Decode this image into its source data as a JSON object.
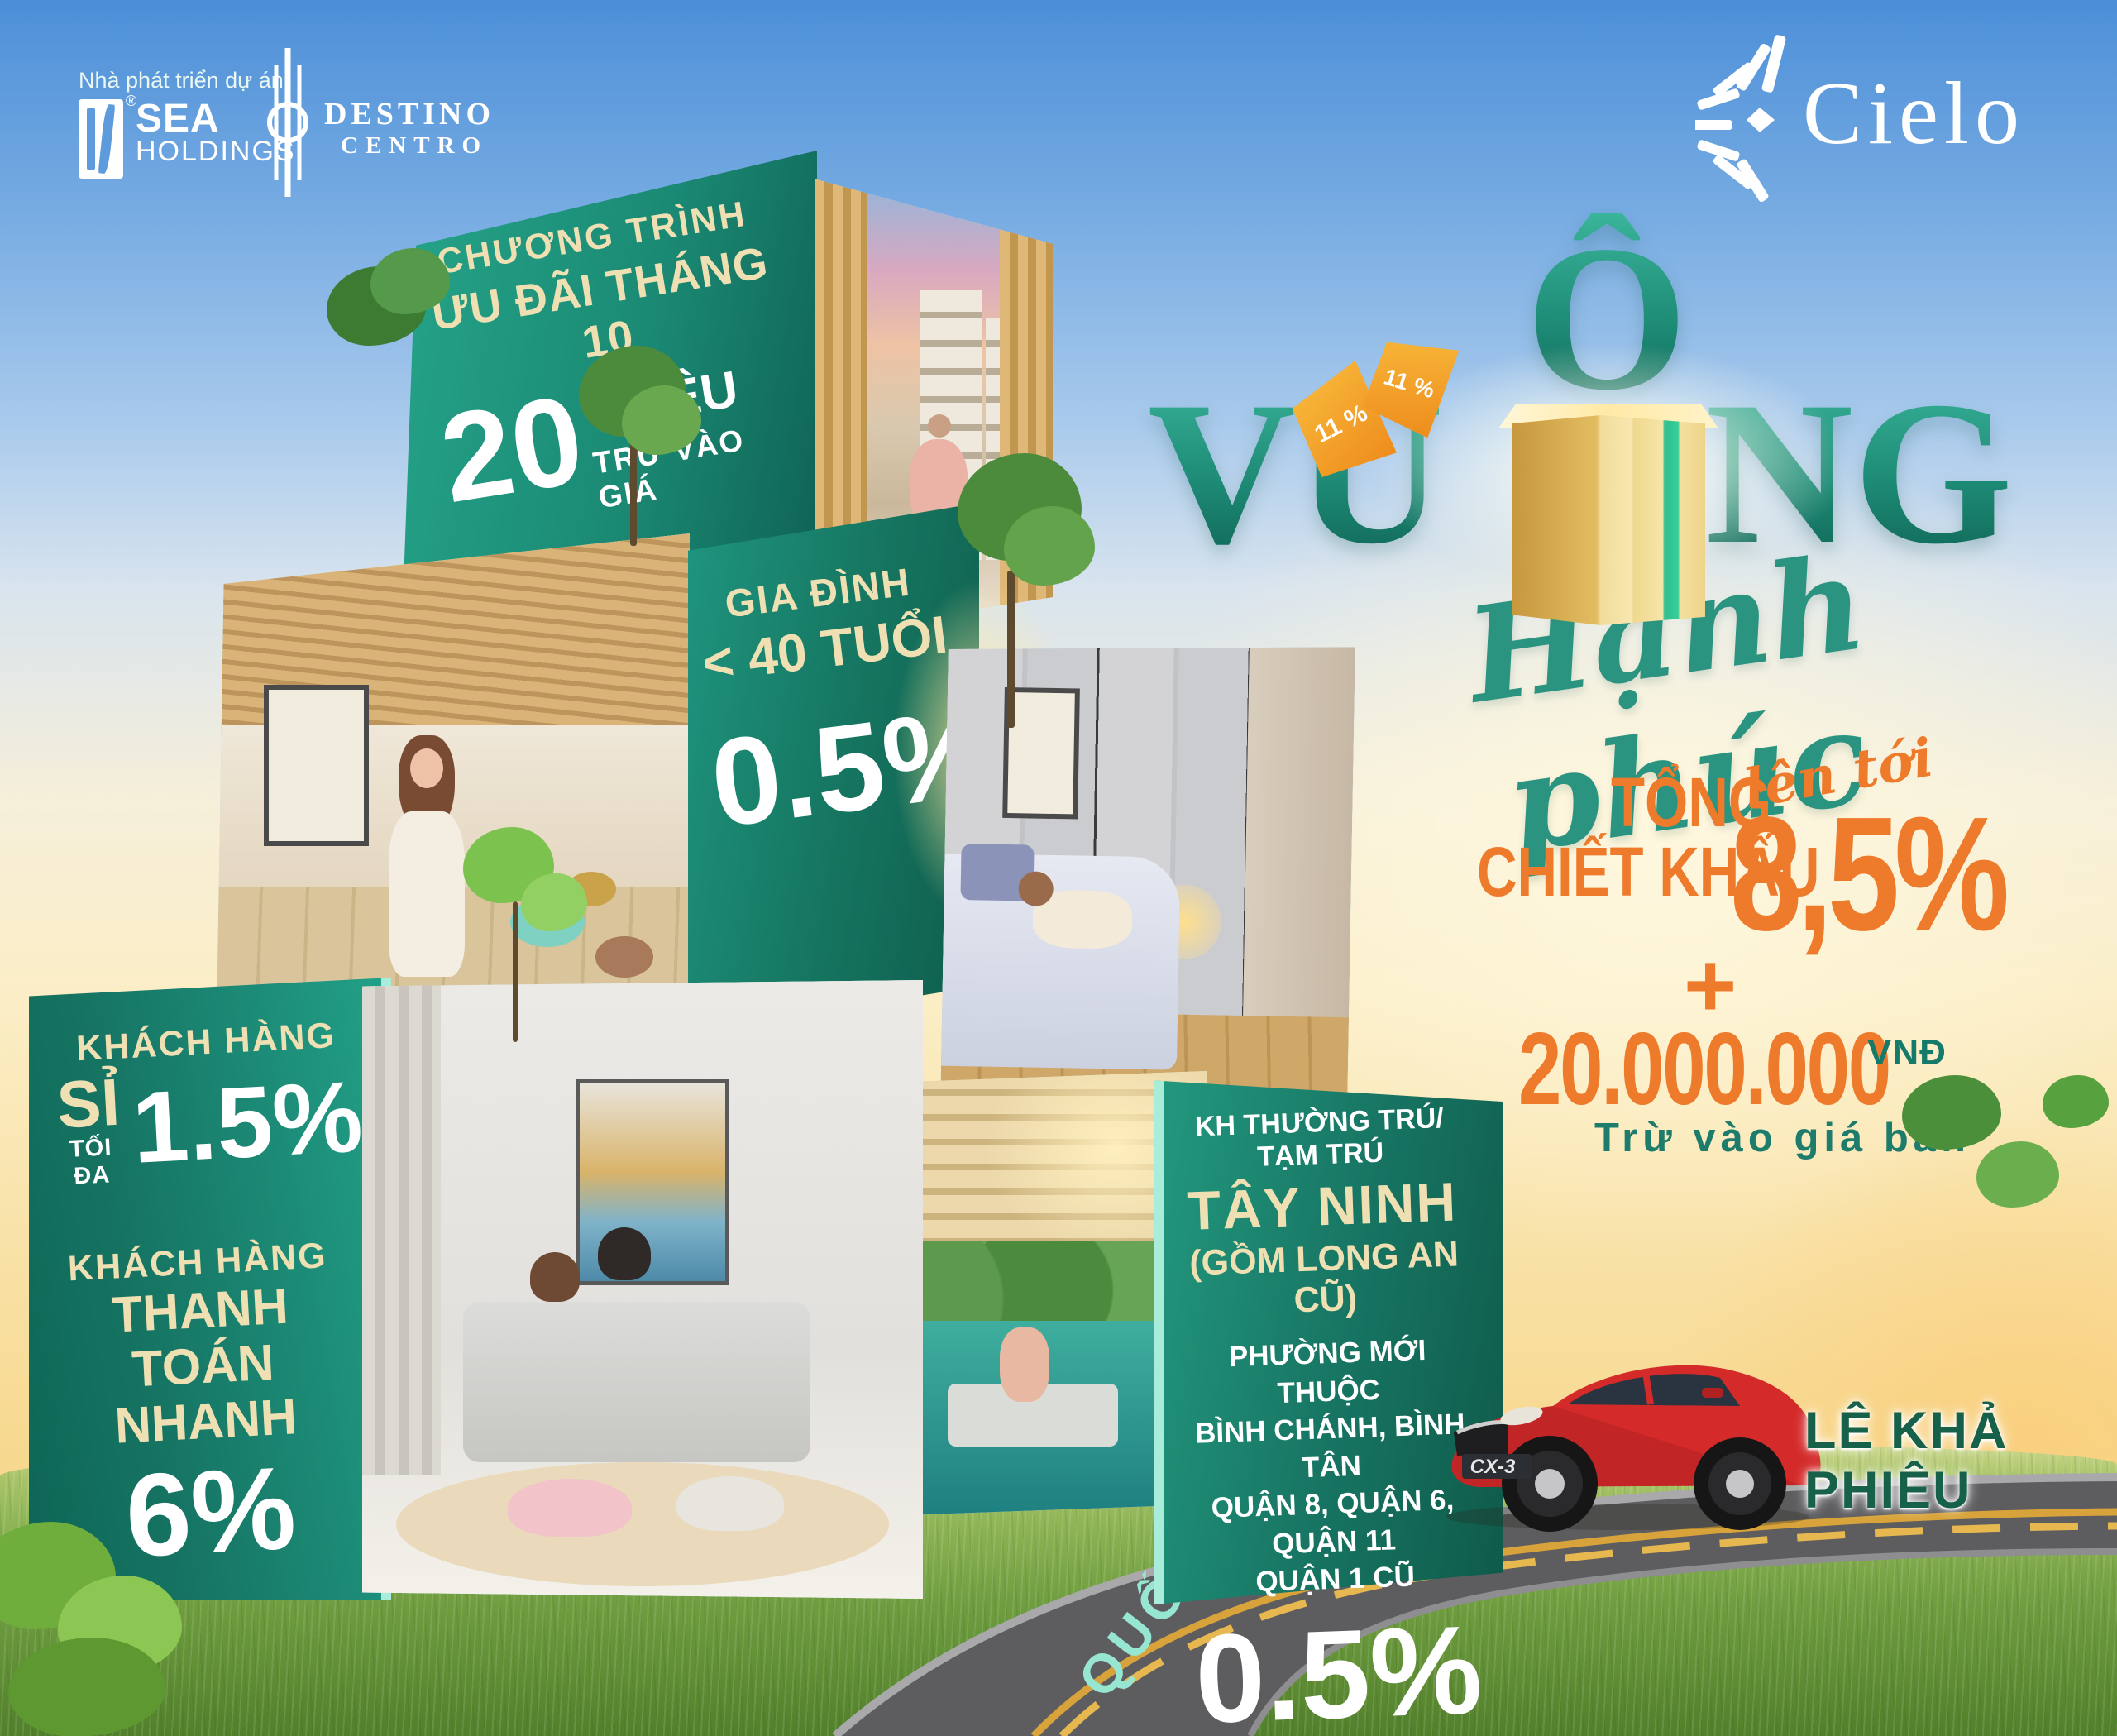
{
  "header": {
    "developer_label": "Nhà phát triển dự án",
    "sea_registered": "®",
    "sea_line1": "SEA",
    "sea_line2": "HOLDINGS",
    "destino_line1": "DESTINO",
    "destino_line2": "CENTRO",
    "cielo": "Cielo"
  },
  "title": {
    "o_letter": "Ô",
    "vu": "VU",
    "ng": "NG",
    "tag": "11 %",
    "script": "Hạnh phúc"
  },
  "offer": {
    "line1": "TỔNG",
    "line2": "CHIẾT KHẤU",
    "up_to": "lên tới",
    "percent": "8,5%",
    "plus": "+",
    "amount": "20.000.000",
    "currency": "VNĐ",
    "note": "Trừ vào giá bán"
  },
  "boxes": {
    "october": {
      "line1": "CHƯƠNG TRÌNH",
      "line2": "ƯU ĐÃI THÁNG 10",
      "big": "20",
      "unit": "TRIỆU",
      "note": "TRỪ VÀO GIÁ"
    },
    "family": {
      "line1": "GIA ĐÌNH",
      "line2": "< 40 TUỔI",
      "percent": "0.5%"
    },
    "wholesale": {
      "line1": "KHÁCH HÀNG",
      "line2": "SỈ",
      "line3": "TỐI ĐA",
      "percent": "1.5%"
    },
    "fast_payment": {
      "line1": "KHÁCH HÀNG",
      "line2": "THANH TOÁN",
      "line3": "NHANH",
      "percent": "6%"
    },
    "residence": {
      "line1": "KH THƯỜNG TRÚ/ TẠM TRÚ",
      "line2": "TÂY NINH",
      "line3": "(GỒM LONG AN CŨ)",
      "line4": "PHƯỜNG MỚI THUỘC",
      "line5": "BÌNH CHÁNH, BÌNH TÂN",
      "line6": "QUẬN 8, QUẬN 6, QUẬN 11",
      "line7": "QUẬN 1 CŨ",
      "percent": "0.5%"
    }
  },
  "road": {
    "highway_label": "QUỐC LỘ 1A",
    "street_label": "LÊ KHẢ PHIÊU",
    "car_model": "CX-3"
  },
  "colors": {
    "accent_orange": "#EE7A2B",
    "teal_face": "#1B8A74",
    "teal_text": "#2B9480",
    "mint_edge": "#A8ECD9",
    "cream_text": "#EFE0B4",
    "street_green": "#17614A",
    "road_mint": "#97E6D2",
    "car_red": "#D42A2A"
  }
}
